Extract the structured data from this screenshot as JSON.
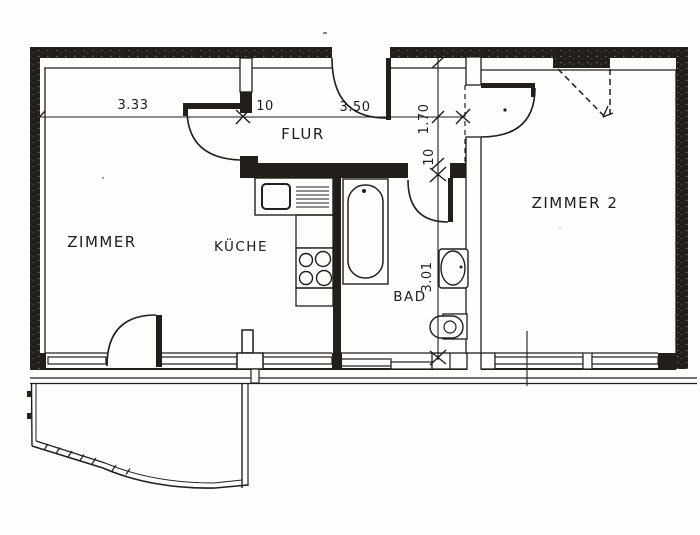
{
  "floor_plan": {
    "title_hint": "apartment floor plan scan",
    "rooms": [
      {
        "id": "zimmer",
        "label": "ZIMMER"
      },
      {
        "id": "kueche",
        "label": "KÜCHE"
      },
      {
        "id": "flur",
        "label": "FLUR"
      },
      {
        "id": "bad",
        "label": "BAD"
      },
      {
        "id": "zimmer2",
        "label": "ZIMMER 2"
      }
    ],
    "dimensions_horizontal": [
      {
        "label": "3.33"
      },
      {
        "label": "10"
      },
      {
        "label": "3.50"
      }
    ],
    "dimensions_vertical": [
      {
        "label": "1.70"
      },
      {
        "label": "10"
      },
      {
        "label": "3.01"
      }
    ],
    "fixtures": [
      "sink-unit",
      "stove",
      "bathtub",
      "washbasin",
      "toilet"
    ],
    "colors": {
      "ink": "#221e1a",
      "paper": "#fdfdfc"
    }
  }
}
